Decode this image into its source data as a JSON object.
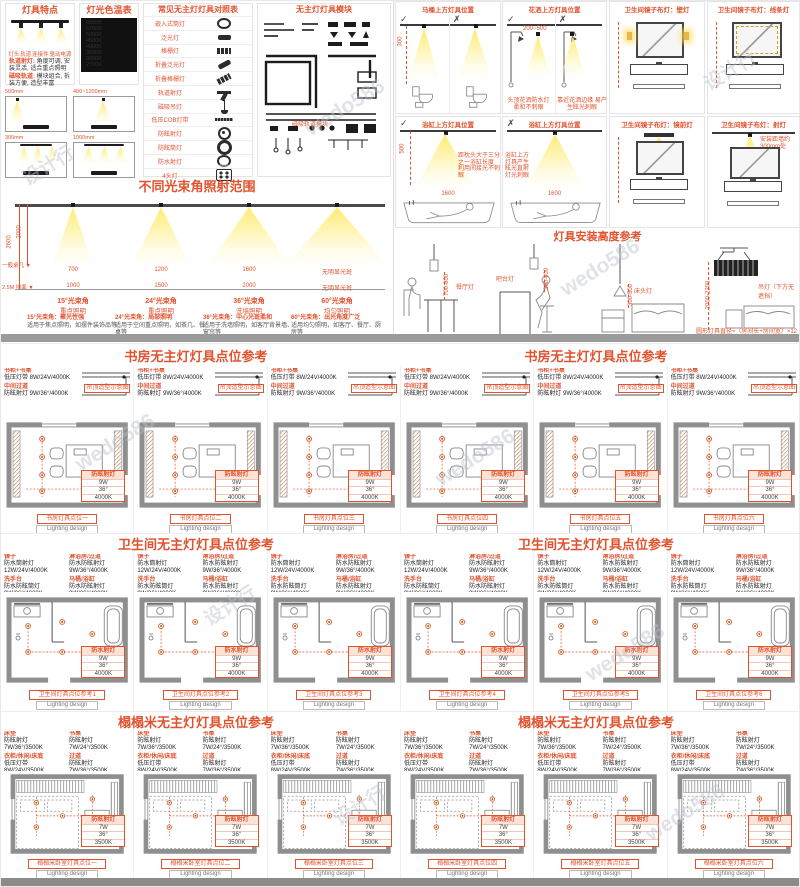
{
  "watermark": {
    "brand": "wedo586",
    "studio": "设计行"
  },
  "colors": {
    "accent": "#e0532f",
    "wall": "#8f8f8f",
    "cone": "#ffe96e"
  },
  "top_left": {
    "features": {
      "title": "灯具特点",
      "part_labels": [
        "灯头",
        "轨道",
        "连接件",
        "驱动电源"
      ],
      "notes": [
        {
          "label": "轨道射灯:",
          "text": "角度可调, 安装灵活, 适合重点照明"
        },
        {
          "label": "磁吸轨道:",
          "text": "模块组合, 拆装方便, 造型丰富"
        }
      ]
    },
    "color_table": {
      "title": "灯光色温表",
      "bars": [
        "6500K",
        "5700K",
        "5000K",
        "4500K",
        "4000K",
        "3500K",
        "3000K",
        "2700K"
      ]
    },
    "legend": {
      "title": "常见无主灯灯具对照表",
      "rows": [
        {
          "name": "嵌入式筒灯",
          "icon": "downlight"
        },
        {
          "name": "泛光灯",
          "icon": "flood"
        },
        {
          "name": "格栅灯",
          "icon": "grille"
        },
        {
          "name": "折叠泛光灯",
          "icon": "fold-flood"
        },
        {
          "name": "折叠格栅灯",
          "icon": "fold-grille"
        },
        {
          "name": "轨道射灯",
          "icon": "track-spot"
        },
        {
          "name": "磁吸吊灯",
          "icon": "pendant"
        },
        {
          "name": "低压COB灯带",
          "icon": "strip"
        },
        {
          "name": "防眩射灯",
          "icon": "ag-spot"
        },
        {
          "name": "防眩筒灯",
          "icon": "ag-down"
        },
        {
          "name": "防水射灯",
          "icon": "wp-spot"
        },
        {
          "name": "4头灯",
          "icon": "four-head"
        }
      ]
    },
    "modules": {
      "title": "无主灯灯具模块",
      "caption": "磁吸轨道模块"
    },
    "rooms": [
      {
        "dim": "500mm"
      },
      {
        "dim": "400~1200mm"
      },
      {
        "dim": "300mm"
      },
      {
        "dim": "1000mm"
      }
    ]
  },
  "beam": {
    "title": "不同光束角照射范围",
    "axis": {
      "total": "2600",
      "upper": "2000",
      "level1": "一般桌几 ▼",
      "level2": "2.5M 地面 ▼"
    },
    "items": [
      {
        "angle": "15°光束角",
        "use": "重点照明",
        "w1": "700",
        "w2": "1000",
        "note": "15°光束角：聚光性强",
        "desc": "适用于焦点照明，如摆件装饰品等"
      },
      {
        "angle": "24°光束角",
        "use": "重点照明",
        "w1": "1200",
        "w2": "1500",
        "note": "24°光束角：局部照明",
        "desc": "适用于空间重点照明，如茶几、餐桌等"
      },
      {
        "angle": "36°光束角",
        "use": "洗墙照明",
        "w1": "1600",
        "w2": "2000",
        "note": "36°光束角：中心光斑柔和",
        "desc": "适用于洗墙照明，如客厅背景墙、窗帘等"
      },
      {
        "angle": "60°光束角",
        "use": "均匀照明",
        "w1": "无明显光斑",
        "w2": "无明显光斑",
        "note": "60°光束角：出光角度广泛",
        "desc": "适用均匀照明，如客厅、餐厅、厨房等"
      }
    ]
  },
  "bath_guide": {
    "toilet": {
      "title": "马桶上方灯具位置",
      "ok": "✓",
      "bad": "✗",
      "dim": "300"
    },
    "shower": {
      "title": "花洒上方灯具位置",
      "ok": "✓",
      "bad": "✗",
      "dim": "200~500",
      "note_ok": "头顶花洒防水灯 柔和不刺眼",
      "note_bad": "靠近花洒边缘 易产生眩光刺眼"
    },
    "bathtub": {
      "title": "浴缸上方灯具位置",
      "ok": "✓",
      "bad": "✗",
      "dim_h": "500",
      "dim_w": "1600",
      "note_ok": "距枕头大于三分之一浴缸长度 利用间接光不刺眼",
      "note_bad": "浴缸上方灯具产生眩光直射 灯光刺眼"
    },
    "mirrors": [
      {
        "title": "卫生间镜子布灯：壁灯",
        "note": ""
      },
      {
        "title": "卫生间镜子布灯：线条灯",
        "note": ""
      },
      {
        "title": "卫生间镜子布灯：镜前灯",
        "note": ""
      },
      {
        "title": "卫生间镜子布灯：射灯",
        "note": "安装距墙约300mm处"
      }
    ]
  },
  "height_ref": {
    "title": "灯具安装高度参考",
    "scenes": [
      {
        "label": "餐厅灯",
        "dim": "700-800"
      },
      {
        "label": "吧台灯",
        "dim": "300-400"
      },
      {
        "label": "床头灯",
        "dim": "300-500"
      },
      {
        "label": "吊灯（下方无遮挡）",
        "dim": "2000-2200"
      }
    ],
    "note": "圆形灯具直径≈（房间长+房间宽）×12"
  },
  "lighting_design": "Lighting design",
  "plan_rows": [
    {
      "heading": "书房无主灯灯具点位参考",
      "ceiling_note": "吊顶造型示意图",
      "ann_pairs": [
        {
          "label": "书柜+书桌",
          "spec": "低压灯带 8W/24V/4000K"
        },
        {
          "label": "中间过道",
          "spec": "防眩射灯 9W/36°/4000K"
        }
      ],
      "callout": {
        "title": "防眩射灯",
        "rows": [
          "9W",
          "36°",
          "4000K"
        ]
      },
      "plans": [
        {
          "caption": "书房灯具点位一"
        },
        {
          "caption": "书房灯具点位二"
        },
        {
          "caption": "书房灯具点位三"
        },
        {
          "caption": "书房灯具点位四"
        },
        {
          "caption": "书房灯具点位五"
        },
        {
          "caption": "书房灯具点位六"
        }
      ]
    },
    {
      "heading": "卫生间无主灯灯具点位参考",
      "ann_pairs": [
        {
          "label": "镜子",
          "spec": "防水筒射灯 12W/24V/4000K"
        },
        {
          "label": "淋浴房/过道",
          "spec": "防水防眩射灯 9W/36°/4000K"
        },
        {
          "label": "洗手台",
          "spec": "防水防眩筒灯 9W/36°/4000K"
        },
        {
          "label": "马桶/浴缸",
          "spec": "防水防眩射灯 9W/36°/4000K"
        }
      ],
      "callout": {
        "title": "防水射灯",
        "rows": [
          "9W",
          "36°",
          "4000K"
        ]
      },
      "plans": [
        {
          "caption": "卫生间灯具点位参考1"
        },
        {
          "caption": "卫生间灯具点位参考2"
        },
        {
          "caption": "卫生间灯具点位参考3"
        },
        {
          "caption": "卫生间灯具点位参考4"
        },
        {
          "caption": "卫生间灯具点位参考5"
        },
        {
          "caption": "卫生间灯具点位参考6"
        }
      ]
    },
    {
      "heading": "榻榻米无主灯灯具点位参考",
      "ann_pairs": [
        {
          "label": "床垫",
          "spec": "防眩射灯 7W/36°/3500K"
        },
        {
          "label": "书桌",
          "spec": "防眩射灯 7W/24°/3500K"
        },
        {
          "label": "衣柜/休闲/床底",
          "spec": "低压灯带 8W/24V/3500K"
        },
        {
          "label": "过道",
          "spec": "防眩射灯 7W/36°/3500K"
        }
      ],
      "callout": {
        "title": "防眩射灯",
        "rows": [
          "7W",
          "36°",
          "3500K"
        ]
      },
      "plans": [
        {
          "caption": "榻榻米卧室灯具点位一"
        },
        {
          "caption": "榻榻米卧室灯具点位二"
        },
        {
          "caption": "榻榻米卧室灯具点位三"
        },
        {
          "caption": "榻榻米卧室灯具点位四"
        },
        {
          "caption": "榻榻米卧室灯具点位五"
        },
        {
          "caption": "榻榻米卧室灯具点位六"
        }
      ]
    }
  ]
}
